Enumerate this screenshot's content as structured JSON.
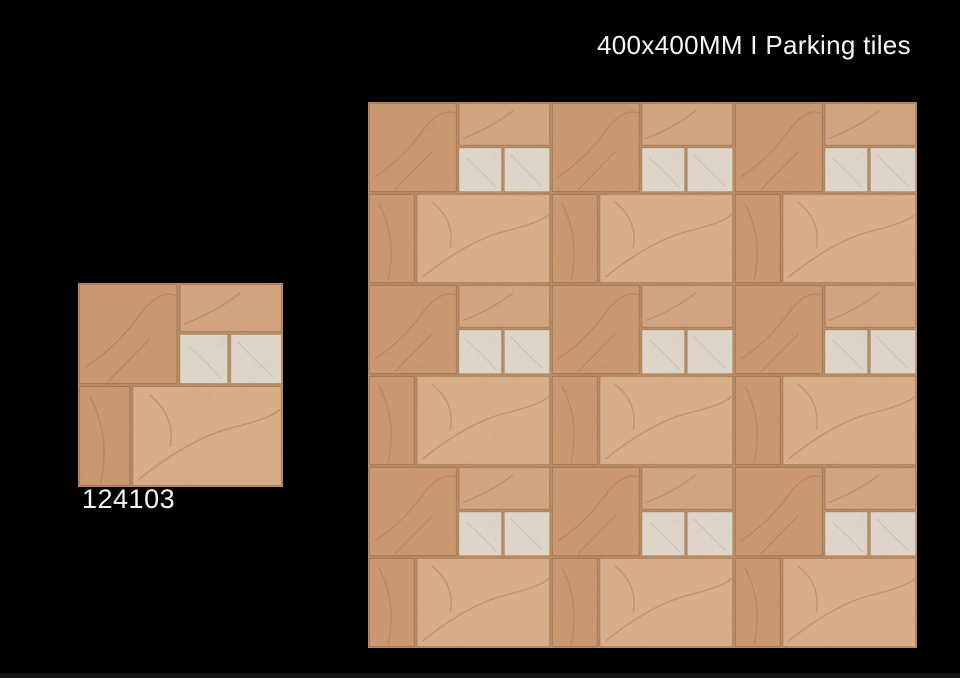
{
  "header": {
    "title": "400x400MM I Parking tiles"
  },
  "product": {
    "code": "124103"
  },
  "colors": {
    "bg": "#000000",
    "text": "#f7f7f7",
    "grout": "#ba8c66",
    "stone_tan": "#d3a37f",
    "stone_tan_dark": "#c9986f",
    "stone_tan_light": "#d9ac88",
    "stone_cream": "#ddd5c8",
    "vein": "#a87b54"
  }
}
